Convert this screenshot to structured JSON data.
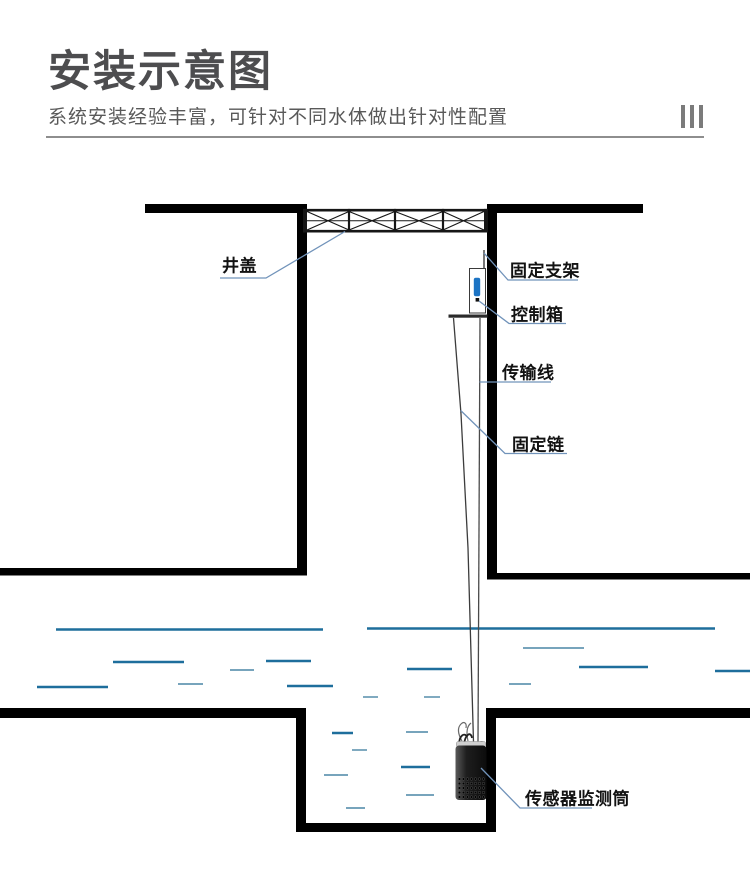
{
  "header": {
    "title": "安装示意图",
    "subtitle": "系统安装经验丰富，可针对不同水体做出针对性配置",
    "decoration_bar_count": 3
  },
  "diagram": {
    "labels": {
      "manhole_cover": "井盖",
      "fixed_bracket": "固定支架",
      "control_box": "控制箱",
      "transmission_line": "传输线",
      "fixed_chain": "固定链",
      "sensor_cylinder": "传感器监测筒"
    },
    "colors": {
      "structure_black": "#000000",
      "water_dark": "#1e6e9c",
      "water_light": "#4a85a6",
      "leader_blue": "#7193ba",
      "indicator_blue": "#1c74c4",
      "title_text": "#4d4d4f",
      "subtitle_text": "#595959",
      "rule_gray": "#8e8e8e"
    }
  }
}
